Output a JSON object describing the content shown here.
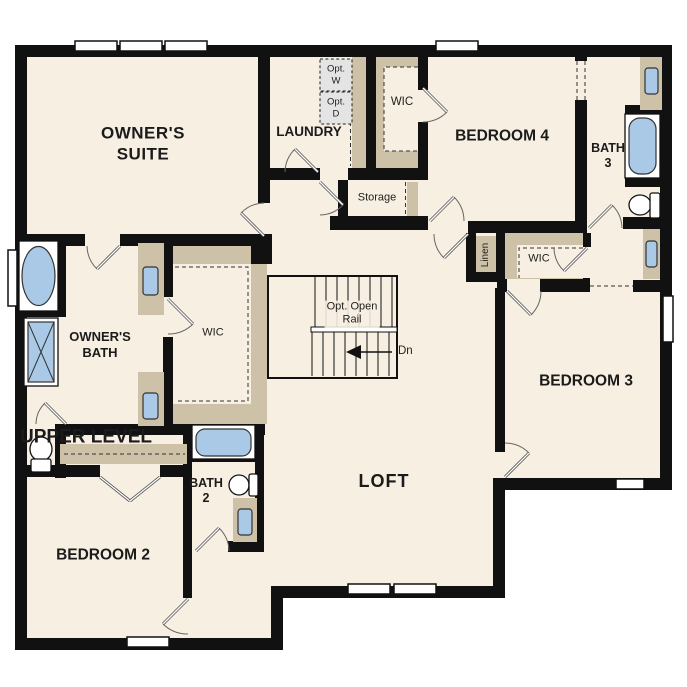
{
  "plan": {
    "title": "UPPER LEVEL"
  },
  "rooms": {
    "owners_suite": {
      "line1": "OWNER'S",
      "line2": "SUITE"
    },
    "laundry": {
      "label": "LAUNDRY"
    },
    "wic_top": {
      "label": "WIC"
    },
    "bedroom4": {
      "label": "BEDROOM 4"
    },
    "bath3": {
      "line1": "BATH",
      "line2": "3"
    },
    "storage": {
      "label": "Storage"
    },
    "linen": {
      "label": "Linen"
    },
    "wic_bedroom3": {
      "label": "WIC"
    },
    "owners_bath": {
      "line1": "OWNER'S",
      "line2": "BATH"
    },
    "wic_owner": {
      "label": "WIC"
    },
    "bedroom3": {
      "label": "BEDROOM 3"
    },
    "bedroom2": {
      "label": "BEDROOM 2"
    },
    "bath2": {
      "line1": "BATH",
      "line2": "2"
    },
    "loft": {
      "label": "LOFT"
    }
  },
  "stairs": {
    "note_line1": "Opt. Open",
    "note_line2": "Rail",
    "direction": "Dn"
  },
  "appliances": {
    "washer": {
      "line1": "Opt.",
      "line2": "W"
    },
    "dryer": {
      "line1": "Opt.",
      "line2": "D"
    }
  },
  "colors": {
    "floor": "#f7efe2",
    "cabinet": "#cdc1a7",
    "wall": "#111111",
    "fixture": "#a9c9e7",
    "appliance": "#e4e4e4"
  }
}
